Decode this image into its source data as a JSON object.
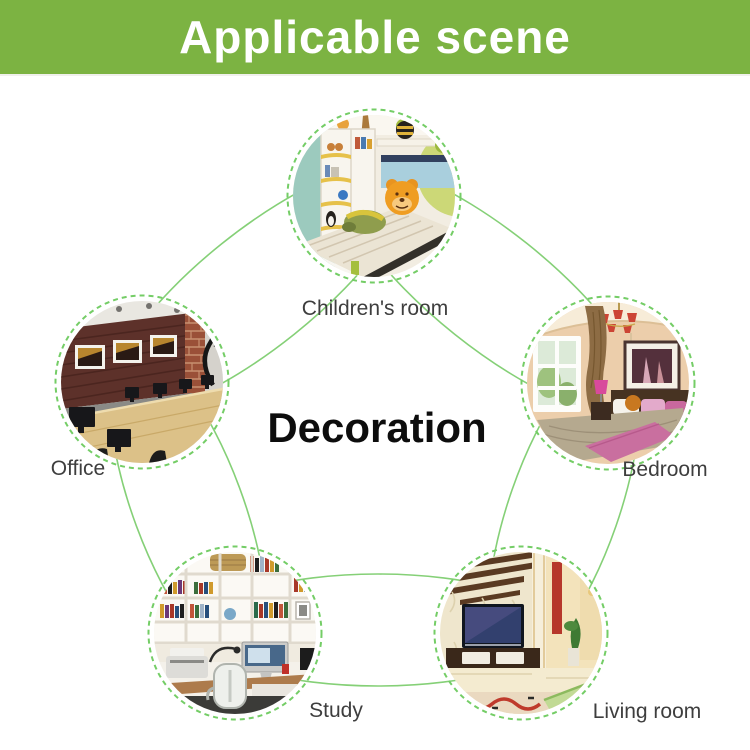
{
  "header": {
    "title": "Applicable scene"
  },
  "center_label": "Decoration",
  "colors": {
    "header_green": "#7cb342",
    "connector_green": "#85d077",
    "dashed_ring_green": "#74cd66",
    "label_gray": "#3e3e3e",
    "center_text": "#0d0d0d"
  },
  "diagram": {
    "nodes": [
      {
        "id": "childrens-room",
        "label": "Children's room",
        "photo_desc": "child bedroom with white shelves, toys and orange plush bear on bed"
      },
      {
        "id": "office",
        "label": "Office",
        "photo_desc": "office with dark wood wall, three framed pictures and long desk with monitors"
      },
      {
        "id": "bedroom",
        "label": "Bedroom",
        "photo_desc": "bedroom with window, curtain, pink accents and framed picture"
      },
      {
        "id": "study",
        "label": "Study",
        "photo_desc": "study with white bookshelves, desk computer and white chair"
      },
      {
        "id": "living-room",
        "label": "Living room",
        "photo_desc": "living room with TV console, patterned wallpaper and red rug"
      }
    ]
  }
}
